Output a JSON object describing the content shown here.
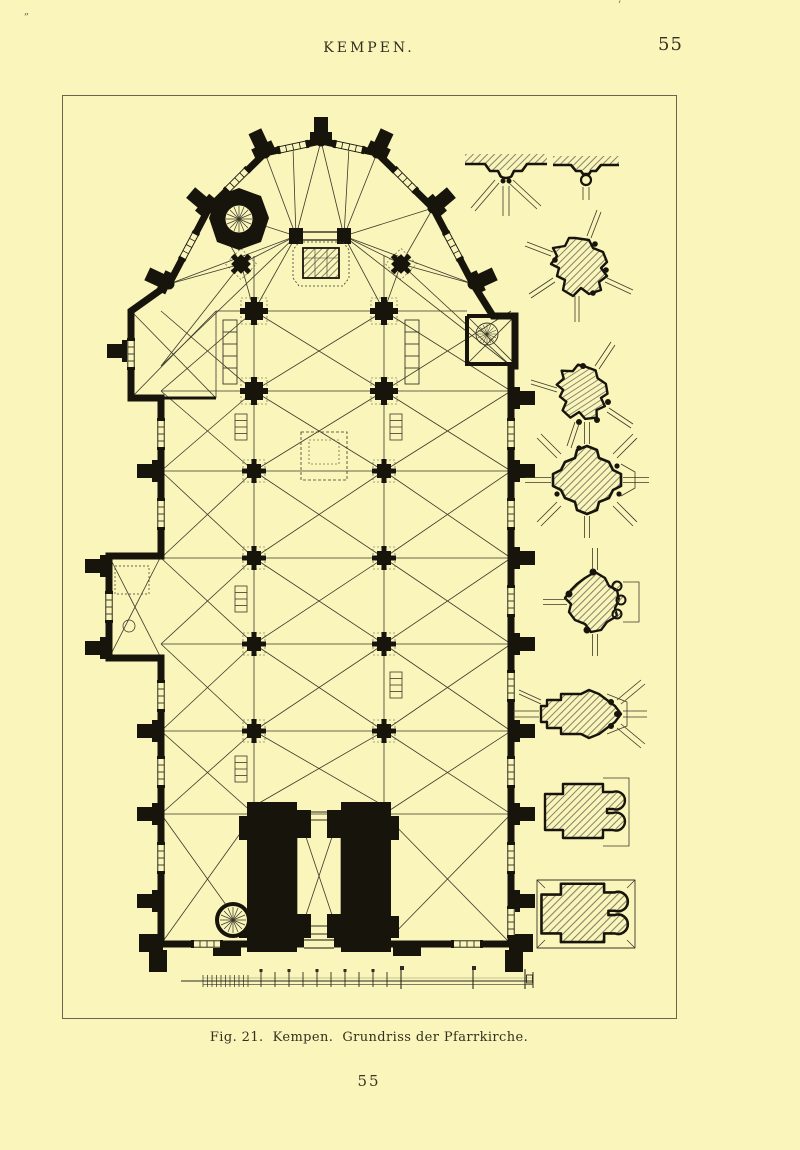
{
  "page": {
    "paper_color": "#f9f5bb",
    "ink_color": "#2e2b20",
    "plan_ink_color": "#17140c",
    "frame_color": "#6a6550",
    "margin_marks": {
      "top_left": "„",
      "top_right": "’"
    }
  },
  "header": {
    "running_title": "KEMPEN.",
    "page_number": "55"
  },
  "figure": {
    "caption": "Fig. 21.  Kempen.  Grundriss der Pfarrkirche.",
    "content_type": "architectural floor plan engraving",
    "main_drawing": "floor-plan-parish-church-kempen",
    "side_section_names": [
      "wall-respond-profile-left",
      "wall-respond-profile-right",
      "choir-pier-section",
      "apse-pier-section",
      "crossing-pier-section",
      "nave-pier-section",
      "respond-pier-section",
      "tower-pier-section-upper",
      "tower-pier-section-lower"
    ],
    "scale_bar": "graphic-scale-with-tick-divisions"
  },
  "footer": {
    "page_number": "55"
  }
}
